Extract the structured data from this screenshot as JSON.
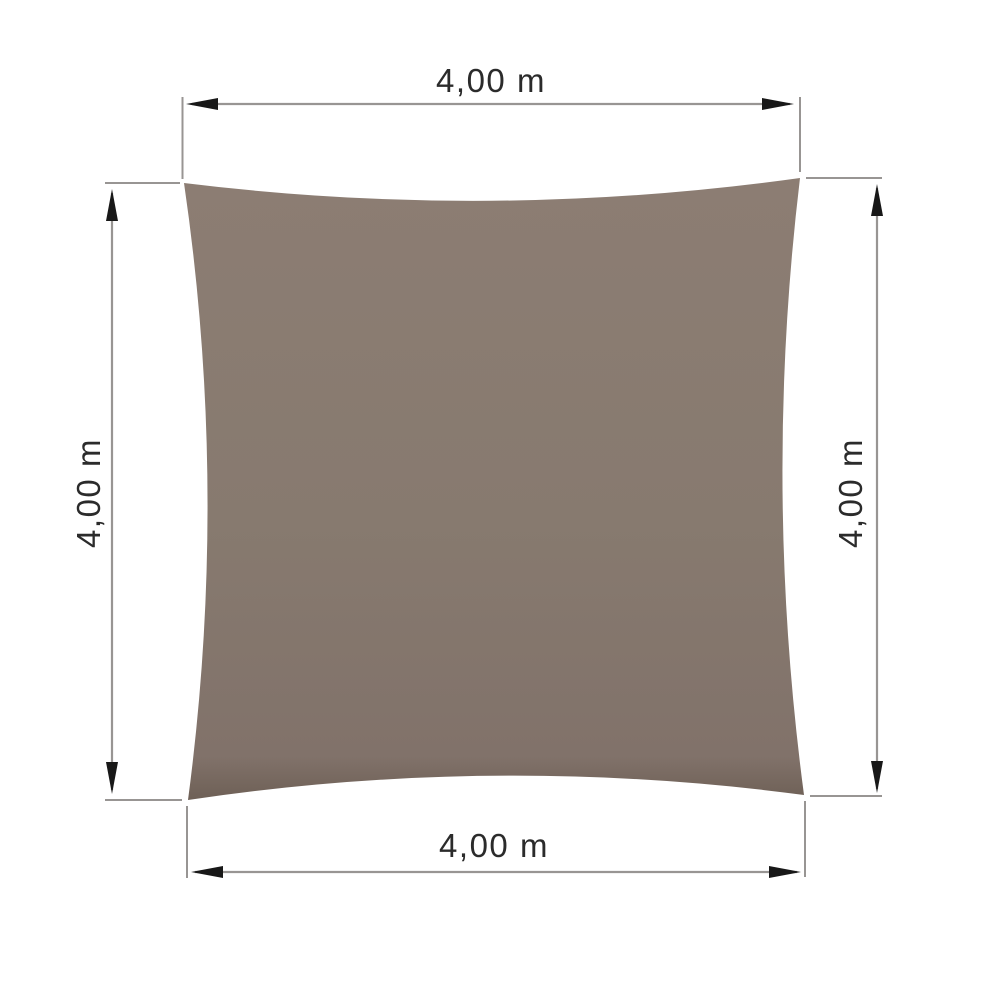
{
  "diagram": {
    "type": "shade-sail-dimension-drawing",
    "sail": {
      "shape": "square-concave",
      "color_top": "#8c7d73",
      "color_mid": "#877a6f",
      "color_low": "#81726a",
      "color_bottom_edge": "#6e6056"
    },
    "lines": {
      "color": "#989593"
    },
    "arrows": {
      "color": "#181818"
    },
    "text": {
      "color": "#2b2b2b"
    },
    "dimensions": {
      "top": {
        "label": "4,00 m"
      },
      "bottom": {
        "label": "4,00 m"
      },
      "left": {
        "label": "4,00 m"
      },
      "right": {
        "label": "4,00 m"
      }
    }
  }
}
